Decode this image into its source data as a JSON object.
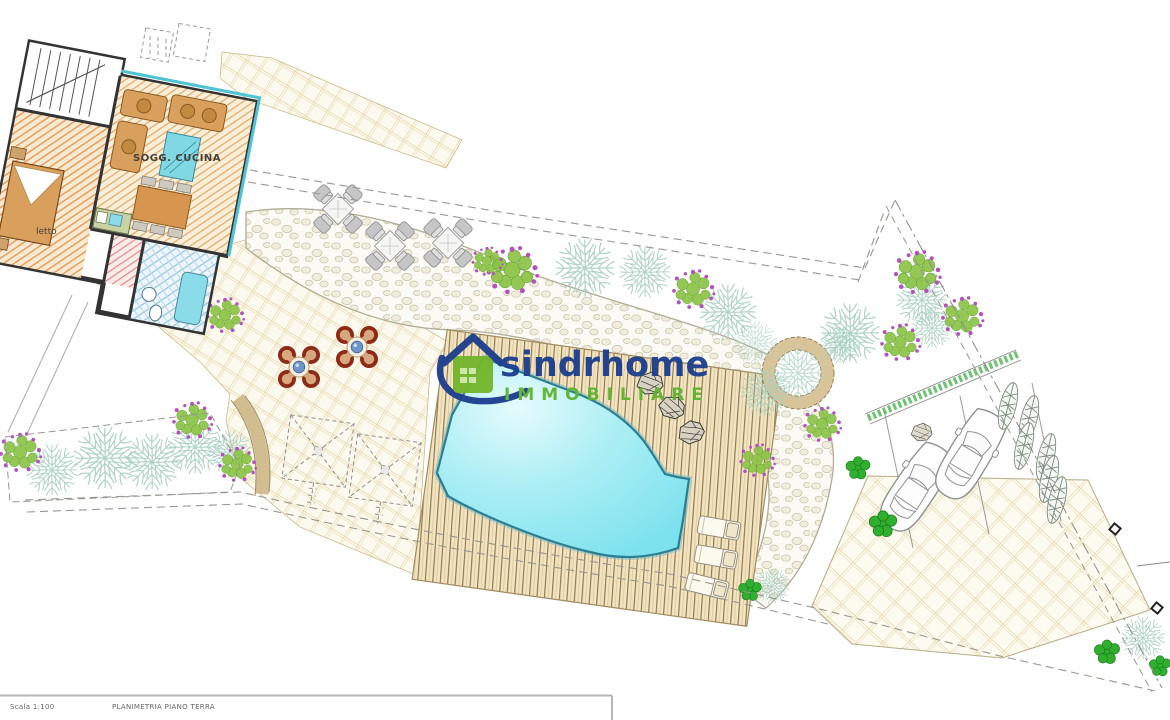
{
  "floorplan_labels": {
    "living": "SOGG. CUCINA",
    "bedroom": "letto"
  },
  "watermark": {
    "brand": "sindrhome",
    "subtitle": "IMMOBILIARE",
    "brand_color": "#1e3f8e",
    "subtitle_color": "#5fb42e"
  },
  "title_block": {
    "sheet_code": "Scala 1:100",
    "drawing_title": "PLANIMETRIA PIANO TERRA"
  },
  "icons": {
    "logo": "house-logo-icon"
  },
  "colors": {
    "pool_water": "#86e6f0",
    "pool_edge": "#2a7f93",
    "deck_wood": "#f3e5c2",
    "tile_line": "#dcc58c",
    "hatch_orange": "#e39a5d",
    "hatch_blue": "#93c4df",
    "teal_tree": "#a8cfc2",
    "flower_tree_green": "#8cc446",
    "flower_purple": "#b351bd",
    "bush_green": "#2fae2f",
    "red_chair": "#8e2a16",
    "boundary_gray": "#979790"
  }
}
